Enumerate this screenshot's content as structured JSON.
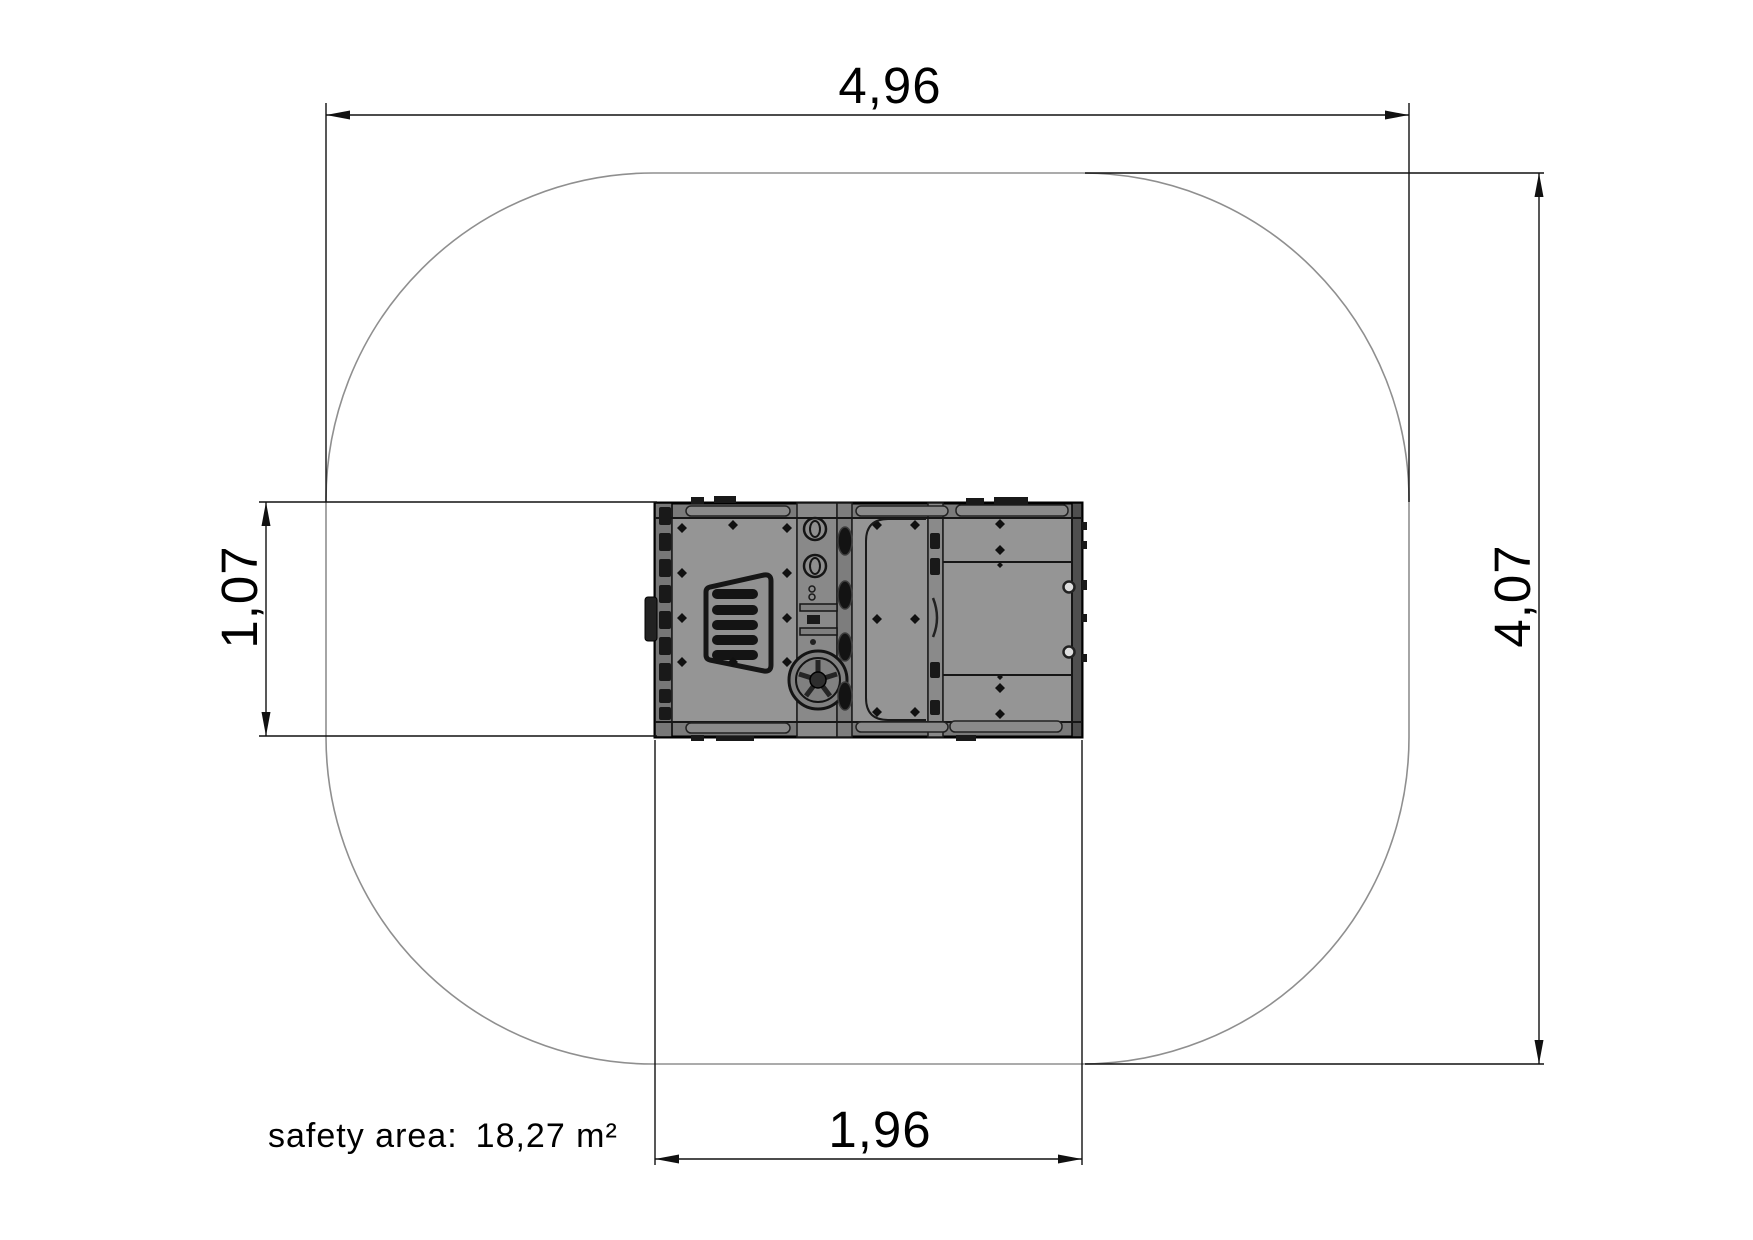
{
  "drawing": {
    "type": "top-view safety-area plan of playground equipment",
    "dimensions": {
      "overall_width": "4,96",
      "overall_height": "4,07",
      "equipment_height": "1,07",
      "equipment_width": "1,96"
    },
    "safety": {
      "label": "safety area:",
      "value": "18,27 m²"
    },
    "colors": {
      "dimension_line": "#111111",
      "safety_outline": "#8f8f8f",
      "equipment_panel_fill": "#959595",
      "equipment_frame_fill": "#7a7a7a",
      "detail_dark": "#191919",
      "background": "#ffffff"
    }
  }
}
